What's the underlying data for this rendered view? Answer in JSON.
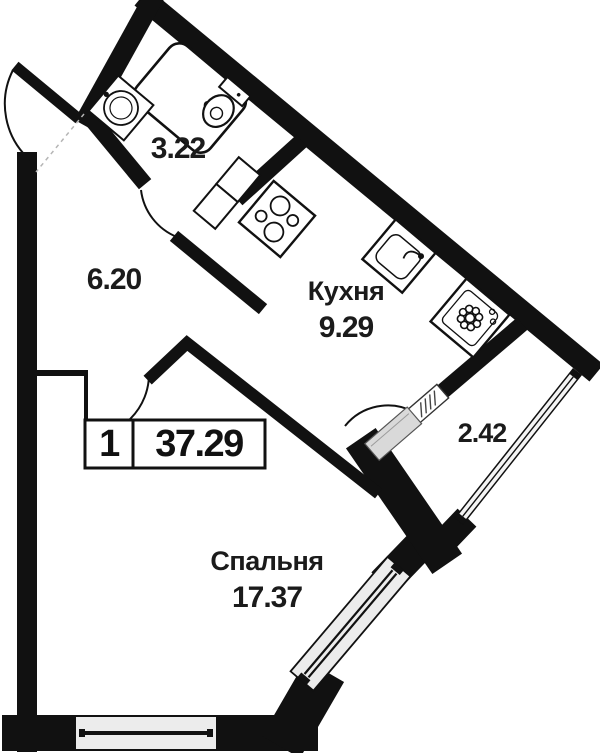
{
  "plan": {
    "apartment_label": {
      "room_count": "1",
      "total_area": "37.29"
    },
    "rooms": [
      {
        "key": "bathroom",
        "name": "",
        "area": "3.22"
      },
      {
        "key": "hallway",
        "name": "",
        "area": "6.20"
      },
      {
        "key": "kitchen",
        "name": "Кухня",
        "area": "9.29"
      },
      {
        "key": "balcony",
        "name": "",
        "area": "2.42"
      },
      {
        "key": "bedroom",
        "name": "Спальня",
        "area": "17.37"
      }
    ],
    "fixtures": [
      "bathtub",
      "washbasin",
      "toilet",
      "kitchen-counter",
      "stove",
      "kitchen-sink",
      "washing-machine"
    ],
    "colors": {
      "wall": "#111111",
      "window_fill": "#ececec",
      "glazing_fill": "#f4f4f4",
      "door_leaf_fill": "#d9d9d9",
      "text": "#1b1b1b",
      "background": "#ffffff"
    }
  }
}
